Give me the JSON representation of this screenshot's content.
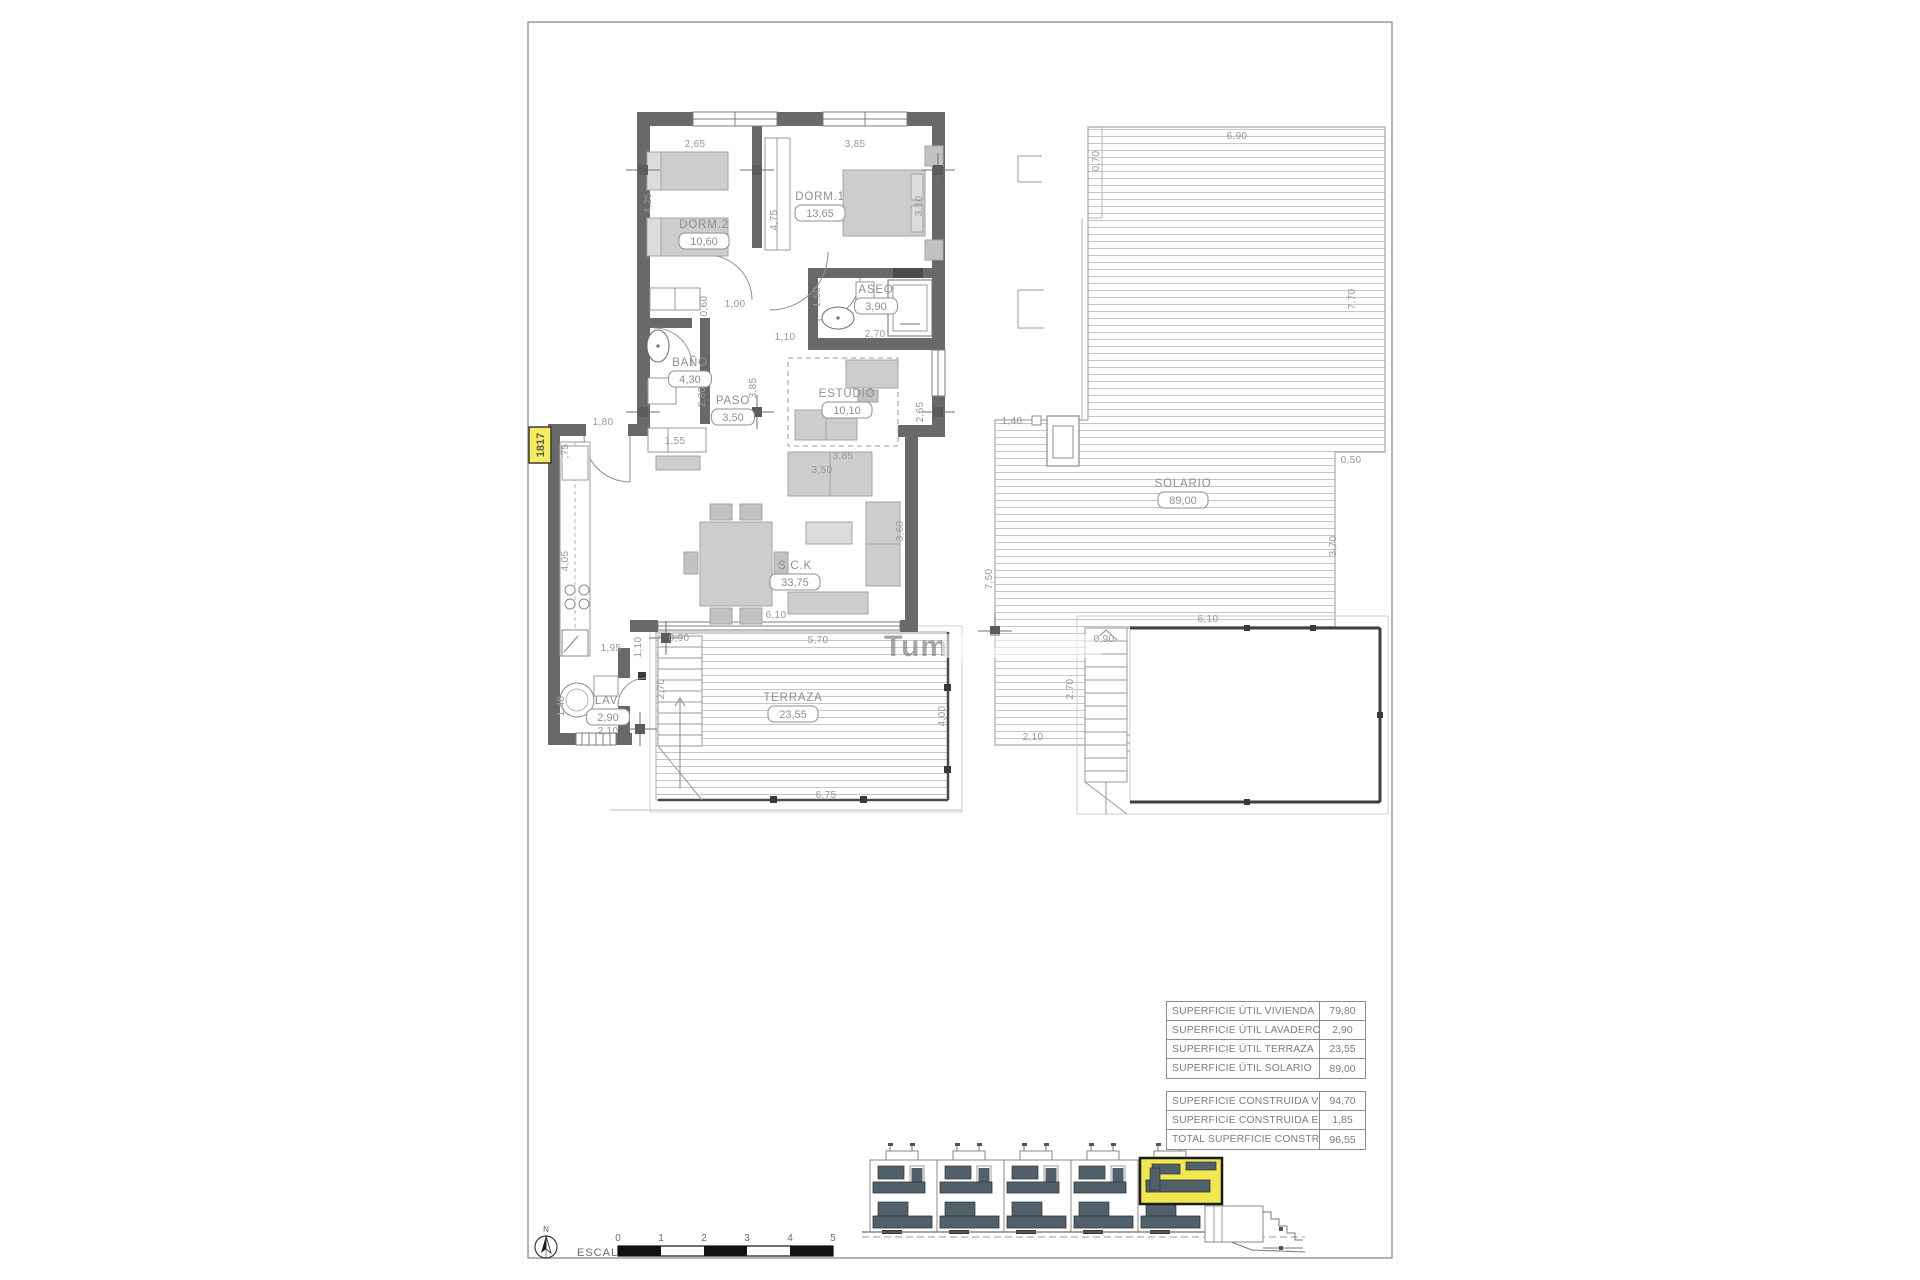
{
  "sheet": {
    "escala_label": "ESCALA :",
    "scale_ticks": [
      "0",
      "1",
      "2",
      "3",
      "4",
      "5"
    ],
    "north_label": "N",
    "unit_tag": "1817",
    "watermark_visible_text": "Tum"
  },
  "colors": {
    "wall": "#696969",
    "furniture": "#cdcdcd",
    "deck_line": "#c6c6c6",
    "dim_text": "#979797",
    "highlight_yellow": "#f1e74e",
    "tag_yellow": "#f5ec5f",
    "glazing_dark": "#51616c"
  },
  "rooms": [
    {
      "name": "DORM.2",
      "value": "10,60",
      "x": 704,
      "y": 228
    },
    {
      "name": "DORM.1",
      "value": "13,65",
      "x": 820,
      "y": 200
    },
    {
      "name": "ASEO",
      "value": "3,90",
      "x": 876,
      "y": 293
    },
    {
      "name": "BAÑO",
      "value": "4,30",
      "x": 690,
      "y": 366
    },
    {
      "name": "PASO",
      "value": "3,50",
      "x": 733,
      "y": 404
    },
    {
      "name": "ESTUDIO",
      "value": "10,10",
      "x": 847,
      "y": 397
    },
    {
      "name": "S.C.K",
      "value": "33,75",
      "x": 795,
      "y": 569
    },
    {
      "name": "LAV.",
      "value": "2,90",
      "x": 608,
      "y": 704
    },
    {
      "name": "TERRAZA",
      "value": "23,55",
      "x": 793,
      "y": 701
    },
    {
      "name": "SOLARIO",
      "value": "89,00",
      "x": 1183,
      "y": 487
    }
  ],
  "dimensions": [
    {
      "t": "2,65",
      "x": 695,
      "y": 147,
      "v": false
    },
    {
      "t": "3,85",
      "x": 855,
      "y": 147,
      "v": false
    },
    {
      "t": "1,00",
      "x": 735,
      "y": 307,
      "v": false
    },
    {
      "t": "1,10",
      "x": 785,
      "y": 340,
      "v": false
    },
    {
      "t": "2,70",
      "x": 875,
      "y": 337,
      "v": false
    },
    {
      "t": "1,80",
      "x": 603,
      "y": 425,
      "v": false
    },
    {
      "t": "1,55",
      "x": 675,
      "y": 444,
      "v": false
    },
    {
      "t": "3,85",
      "x": 843,
      "y": 459,
      "v": false
    },
    {
      "t": "3,50",
      "x": 822,
      "y": 473,
      "v": false
    },
    {
      "t": "1,95",
      "x": 611,
      "y": 651,
      "v": false
    },
    {
      "t": "0,90",
      "x": 679,
      "y": 641,
      "v": false
    },
    {
      "t": "5,70",
      "x": 818,
      "y": 643,
      "v": false
    },
    {
      "t": "6,10",
      "x": 776,
      "y": 618,
      "v": false
    },
    {
      "t": "6,75",
      "x": 826,
      "y": 798,
      "v": false
    },
    {
      "t": "2,10",
      "x": 608,
      "y": 734,
      "v": false
    },
    {
      "t": "6,90",
      "x": 1237,
      "y": 139,
      "v": false
    },
    {
      "t": "0,50",
      "x": 1351,
      "y": 463,
      "v": false
    },
    {
      "t": "1,40",
      "x": 1012,
      "y": 424,
      "v": false
    },
    {
      "t": "6,10",
      "x": 1208,
      "y": 622,
      "v": false
    },
    {
      "t": "0,90",
      "x": 1104,
      "y": 642,
      "v": false
    },
    {
      "t": "2,10",
      "x": 1033,
      "y": 740,
      "v": false
    },
    {
      "t": "4,25",
      "x": 651,
      "y": 203,
      "v": true
    },
    {
      "t": "4,75",
      "x": 777,
      "y": 220,
      "v": true
    },
    {
      "t": "3,10",
      "x": 922,
      "y": 206,
      "v": true
    },
    {
      "t": "0,60",
      "x": 707,
      "y": 306,
      "v": true
    },
    {
      "t": "1,50",
      "x": 820,
      "y": 297,
      "v": true
    },
    {
      "t": "2,80",
      "x": 705,
      "y": 397,
      "v": true
    },
    {
      "t": "3,85",
      "x": 756,
      "y": 388,
      "v": true
    },
    {
      "t": ",75",
      "x": 568,
      "y": 451,
      "v": true
    },
    {
      "t": "2,65",
      "x": 923,
      "y": 412,
      "v": true
    },
    {
      "t": "3,60",
      "x": 903,
      "y": 531,
      "v": true
    },
    {
      "t": "4,05",
      "x": 568,
      "y": 561,
      "v": true
    },
    {
      "t": "1,10",
      "x": 641,
      "y": 647,
      "v": true
    },
    {
      "t": "2,70",
      "x": 664,
      "y": 689,
      "v": true
    },
    {
      "t": "4,00",
      "x": 945,
      "y": 716,
      "v": true
    },
    {
      "t": "1,40",
      "x": 564,
      "y": 706,
      "v": true
    },
    {
      "t": "0,70",
      "x": 1099,
      "y": 161,
      "v": true
    },
    {
      "t": "7,70",
      "x": 1355,
      "y": 299,
      "v": true
    },
    {
      "t": "3,70",
      "x": 1336,
      "y": 546,
      "v": true
    },
    {
      "t": "7,50",
      "x": 992,
      "y": 579,
      "v": true
    },
    {
      "t": "2,70",
      "x": 1073,
      "y": 689,
      "v": true
    }
  ],
  "tables": {
    "util": [
      {
        "label": "SUPERFICIE ÚTIL VIVIENDA",
        "value": "79,80"
      },
      {
        "label": "SUPERFICIE ÚTIL LAVADERO",
        "value": "2,90"
      },
      {
        "label": "SUPERFICIE ÚTIL TERRAZA",
        "value": "23,55"
      },
      {
        "label": "SUPERFICIE ÚTIL SOLARIO",
        "value": "89,00"
      }
    ],
    "construida": [
      {
        "label": "SUPERFICIE CONSTRUIDA VIVIENDA",
        "value": "94,70"
      },
      {
        "label": "SUPERFICIE CONSTRUIDA EL.COMUNES",
        "value": "1,85"
      },
      {
        "label": "TOTAL SUPERFICIE CONSTRUIDA",
        "value": "96,55"
      }
    ]
  }
}
